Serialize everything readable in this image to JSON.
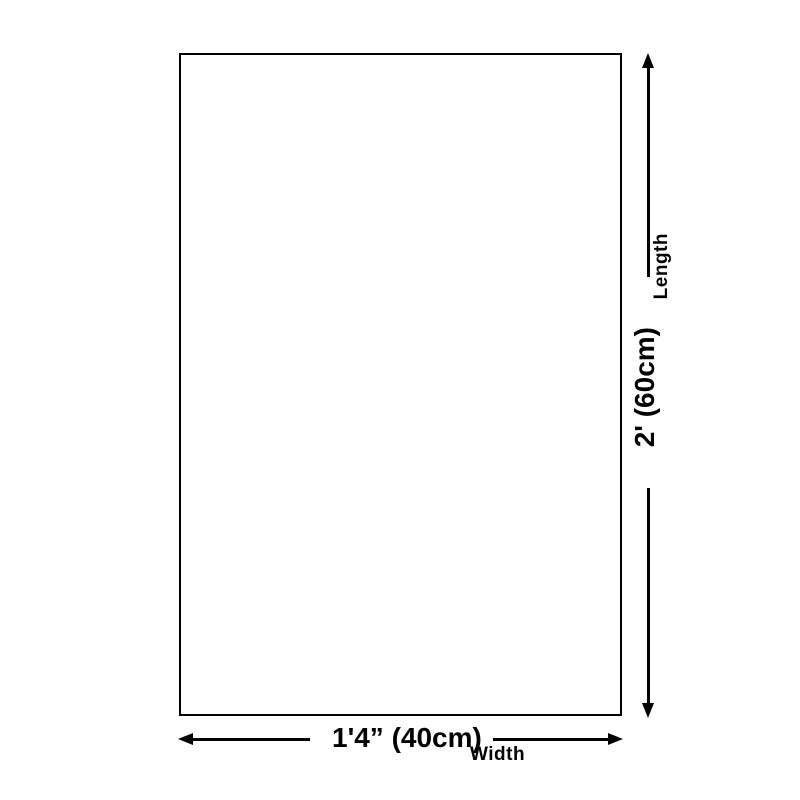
{
  "colors": {
    "line": "#000000",
    "text": "#000000",
    "background": "#ffffff"
  },
  "diagram": {
    "length": {
      "label": "Length",
      "value": "2' (60cm)"
    },
    "width": {
      "label": "Width",
      "value": "1'4” (40cm)"
    }
  }
}
